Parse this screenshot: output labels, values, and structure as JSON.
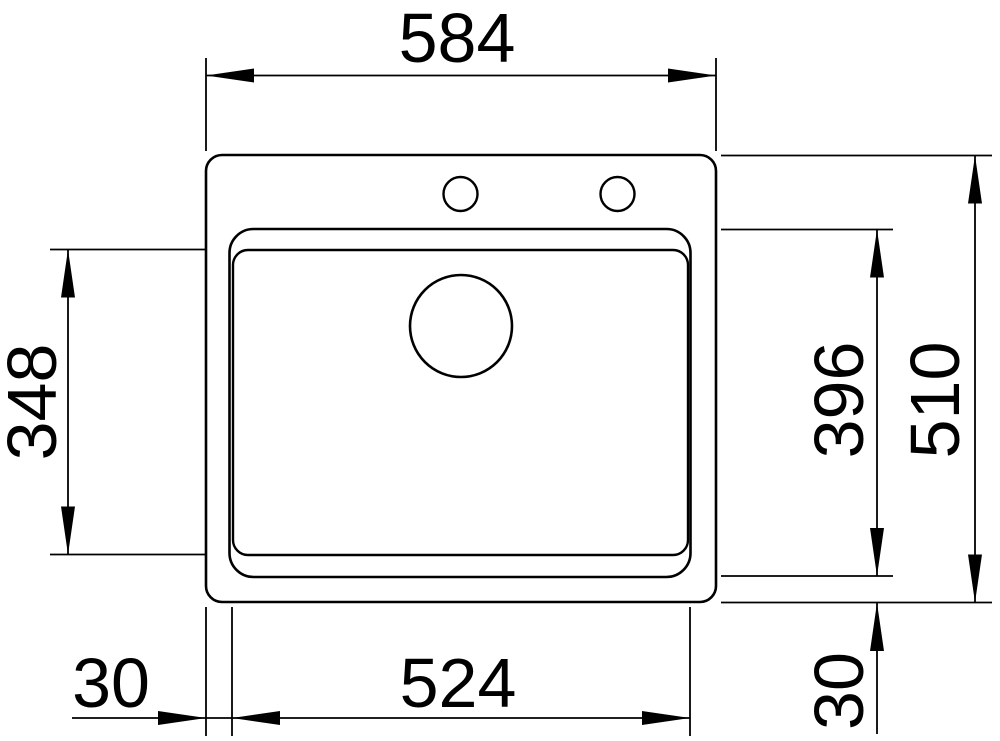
{
  "colors": {
    "line": "#000000",
    "background": "#ffffff"
  },
  "dimensions": {
    "overall_width": "584",
    "bowl_inner_depth": "348",
    "bowl_outer_depth": "396",
    "overall_depth": "510",
    "left_edge_offset": "30",
    "bowl_outer_width": "524",
    "bottom_edge_offset": "30"
  }
}
